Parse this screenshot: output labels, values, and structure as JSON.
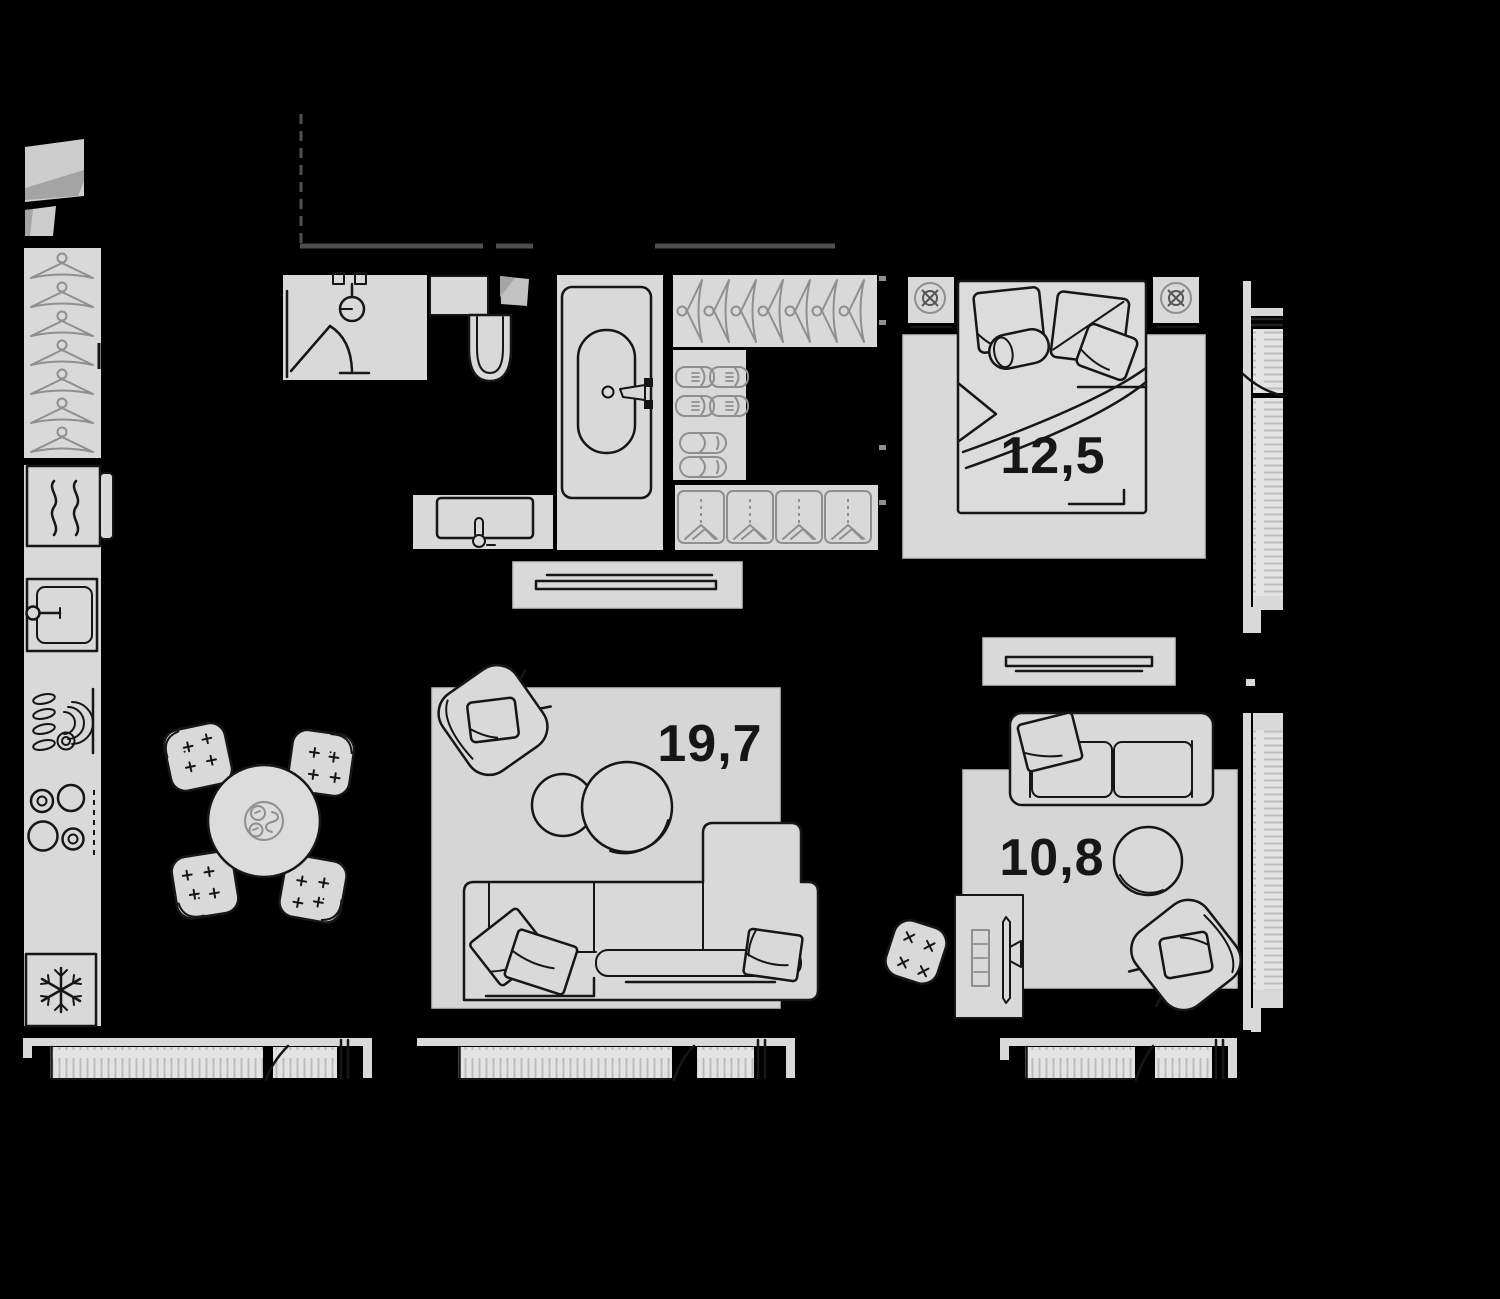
{
  "rooms": [
    {
      "name": "bedroom",
      "area_label": "12,5"
    },
    {
      "name": "living-room",
      "area_label": "19,7"
    },
    {
      "name": "lounge",
      "area_label": "10,8"
    }
  ],
  "palette": {
    "bg": "#000000",
    "floor": "#d9d9d9",
    "floor2": "#dcdcdc",
    "rug": "#d6d6d6",
    "ink": "#161616",
    "soft": "#8f8f8f",
    "wall": "#4f4f4f",
    "glass": "#e3e3e3",
    "hatch": "#bcbcbc",
    "panel": "#cdcdcd",
    "shade": "#a4a4a4",
    "edge": "#c6c6c6"
  }
}
